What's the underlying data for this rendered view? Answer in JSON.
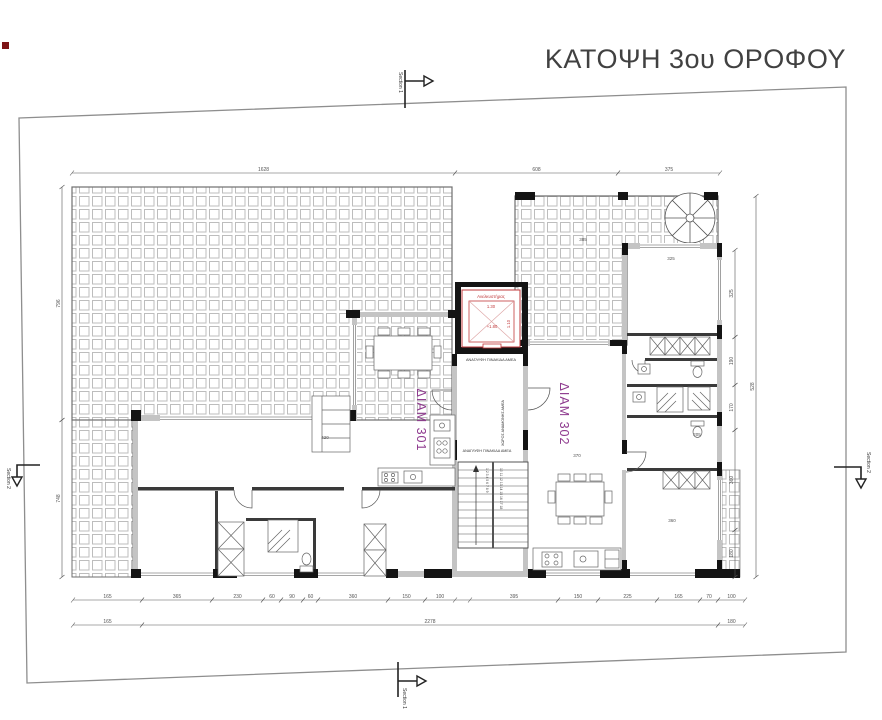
{
  "title": "ΚΑΤΟΨΗ 3ου ΟΡΟΦΟΥ",
  "colors": {
    "line": "#4d4d4d",
    "wall_fill": "#c4c4c4",
    "column": "#141414",
    "tile": "#bdbdbd",
    "red": "#c0393b",
    "purple": "#8e3a8e",
    "dim": "#555555",
    "title_text": "#414141",
    "boundary": "#8e8e8e"
  },
  "section_markers": {
    "top": "Section 1",
    "bottom": "Section 1",
    "left": "Section 2",
    "right": "Section 2"
  },
  "apartments": {
    "a301": "ΔΙΑΜ 301",
    "a302": "ΔΙΑΜ 302"
  },
  "core": {
    "elevator": "Ανελκυστήρας",
    "elevator_width": "1.30",
    "elevator_depth": "1.10",
    "level": "+1.80",
    "braille_sign_top": "ΑΝΑΓΛΥΦΗ ΠΙΝΑΚΙΔΑ ΑΜΕΑ",
    "braille_sign_bottom": "ΑΝΑΓΛΥΦΗ ΠΙΝΑΚΙΔΑ ΑΜΕΑ",
    "wheelchair_waiting": "ΧΩΡΟΣ ΑΝΑΜΟΝΗΣ ΑΜΕΑ",
    "stair_numbers_up": "1 2 3 4 5 6 7 8 9",
    "stair_numbers_down": "10 11 12 13 14 15 16 17 18"
  },
  "dimensions": {
    "chains": [
      {
        "o": "h",
        "pos": 173,
        "segs": [
          [
            72,
            455,
            "1628"
          ],
          [
            455,
            618,
            "608"
          ],
          [
            618,
            720,
            "375"
          ]
        ]
      },
      {
        "o": "h",
        "pos": 600,
        "segs": [
          [
            73,
            142,
            "165"
          ],
          [
            142,
            212,
            "365"
          ],
          [
            212,
            263,
            "230"
          ],
          [
            263,
            281,
            "60"
          ],
          [
            281,
            303,
            "90"
          ],
          [
            303,
            318,
            "60"
          ],
          [
            318,
            388,
            "360"
          ],
          [
            388,
            425,
            "150"
          ],
          [
            425,
            455,
            "100"
          ],
          [
            470,
            558,
            "395"
          ],
          [
            558,
            598,
            "150"
          ],
          [
            598,
            657,
            "225"
          ],
          [
            657,
            700,
            "165"
          ],
          [
            700,
            718,
            "70"
          ],
          [
            718,
            745,
            "100"
          ]
        ]
      },
      {
        "o": "h",
        "pos": 625,
        "segs": [
          [
            73,
            142,
            "165"
          ],
          [
            142,
            718,
            "2278"
          ],
          [
            718,
            745,
            "180"
          ]
        ]
      },
      {
        "o": "v",
        "pos": 62,
        "segs": [
          [
            187,
            420,
            "796"
          ],
          [
            420,
            577,
            "748"
          ]
        ]
      },
      {
        "o": "v",
        "pos": 735,
        "segs": [
          [
            250,
            337,
            "325"
          ],
          [
            337,
            385,
            "190"
          ],
          [
            385,
            430,
            "170"
          ],
          [
            430,
            530,
            "360"
          ],
          [
            530,
            577,
            "180"
          ]
        ]
      },
      {
        "o": "v",
        "pos": 756,
        "segs": [
          [
            196,
            577,
            "528"
          ]
        ]
      }
    ],
    "room_labels": [
      {
        "x": 583,
        "y": 241,
        "t": "385"
      },
      {
        "x": 671,
        "y": 260,
        "t": "325"
      },
      {
        "x": 325,
        "y": 439,
        "t": "420"
      },
      {
        "x": 577,
        "y": 457,
        "t": "370"
      },
      {
        "x": 672,
        "y": 522,
        "t": "360"
      },
      {
        "x": 697,
        "y": 436,
        "t": "205"
      }
    ]
  }
}
